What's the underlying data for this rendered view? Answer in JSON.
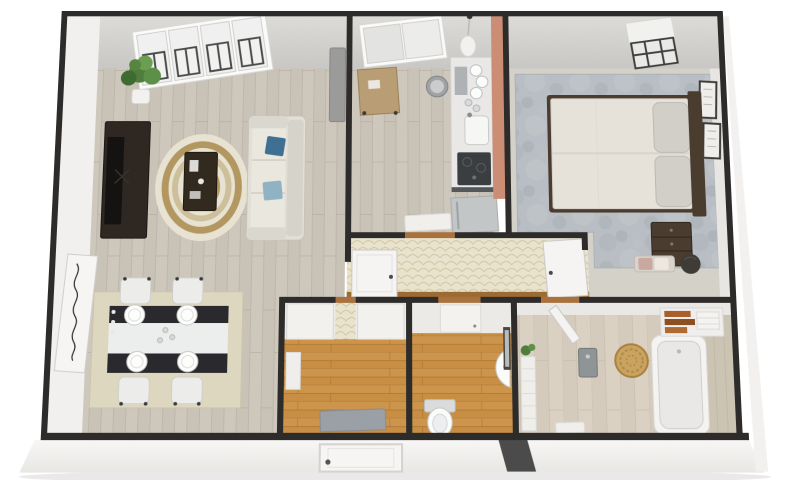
{
  "scene": {
    "title": "3D dollhouse floor plan render of a two-bedroom apartment, viewed top-down at a slight tilt on a white background",
    "render_style": "photoreal 3D floor plan"
  },
  "palette": {
    "wall_dark": "#2e2c2a",
    "wall_face_top": "#d5d4d1",
    "wall_face_side": "#f1f0ee",
    "wood_floor": "#cec7bc",
    "entry_floor_orange": "#c78e44",
    "hall_wallpaper": "#e9e3ce",
    "bath_floor": "#dad1c2",
    "bath_tile": "#ccc4b3",
    "carpet_bluegrey": "#b7bdc3",
    "backsplash_coral": "#cb8e74",
    "sofa": "#e2dfd7",
    "bed_duvet": "#e6e2d9",
    "wood_dark_furniture": "#4a3c2f",
    "tv_unit": "#2e2722",
    "dining_table_dark": "#2a2a2e",
    "dining_rug": "#ded7c0",
    "rug_cream": "#e8e2d2",
    "rug_gold": "#a98a4e",
    "basket_rattan": "#c9a35f",
    "towel_brown": "#a85f28",
    "plant_green": "#4e7d3e",
    "pillow_blue": "#3f6f93",
    "pillow_lightblue": "#8fb3c2",
    "threshold_brown": "#a9713d"
  },
  "rooms": [
    {
      "id": "living-room",
      "floor": "light oak plank"
    },
    {
      "id": "dining-area",
      "floor": "light oak plank"
    },
    {
      "id": "kitchen",
      "floor": "light oak plank"
    },
    {
      "id": "hallway",
      "floor": "wood strip, scallop wallpaper wall with two white doors"
    },
    {
      "id": "entry-storage",
      "floor": "orange oak plank"
    },
    {
      "id": "wc",
      "floor": "orange oak plank"
    },
    {
      "id": "bathroom",
      "floor": "light wood tile"
    },
    {
      "id": "bedroom",
      "floor": "blue-grey carpet"
    }
  ],
  "furniture": {
    "living": [
      "four-panel window",
      "potted plant",
      "tv console with tv",
      "round layered rug",
      "dark coffee table with decor",
      "cream sofa with two blue pillows",
      "leaning wall art",
      "grey wall panel"
    ],
    "dining": [
      "black and white dining table",
      "four white chairs",
      "four place settings",
      "candlesticks",
      "beige rug"
    ],
    "kitchen": [
      "window",
      "pendant lamp",
      "small wood prep table",
      "round trash bin",
      "counter with dish rack",
      "sink",
      "dark cooktop",
      "fridge",
      "coral backsplash",
      "white door mat"
    ],
    "hallway": [
      "white interior door left",
      "white interior door right"
    ],
    "entry": [
      "closet double doors",
      "grey doormat",
      "front entry door on exterior wall",
      "wall box"
    ],
    "wc": [
      "toilet",
      "corner hand basin",
      "wall mirror"
    ],
    "bathroom": [
      "bathtub",
      "rattan basket",
      "towel shelf with brown towels",
      "water heater",
      "towel radiator",
      "small plant",
      "bath mat",
      "open door"
    ],
    "bedroom": [
      "window with dark grille",
      "double bed with cream duvet and two pillows",
      "dark headboard",
      "two framed pictures",
      "dark wood dresser",
      "bench with cushions",
      "dark pouf"
    ]
  }
}
